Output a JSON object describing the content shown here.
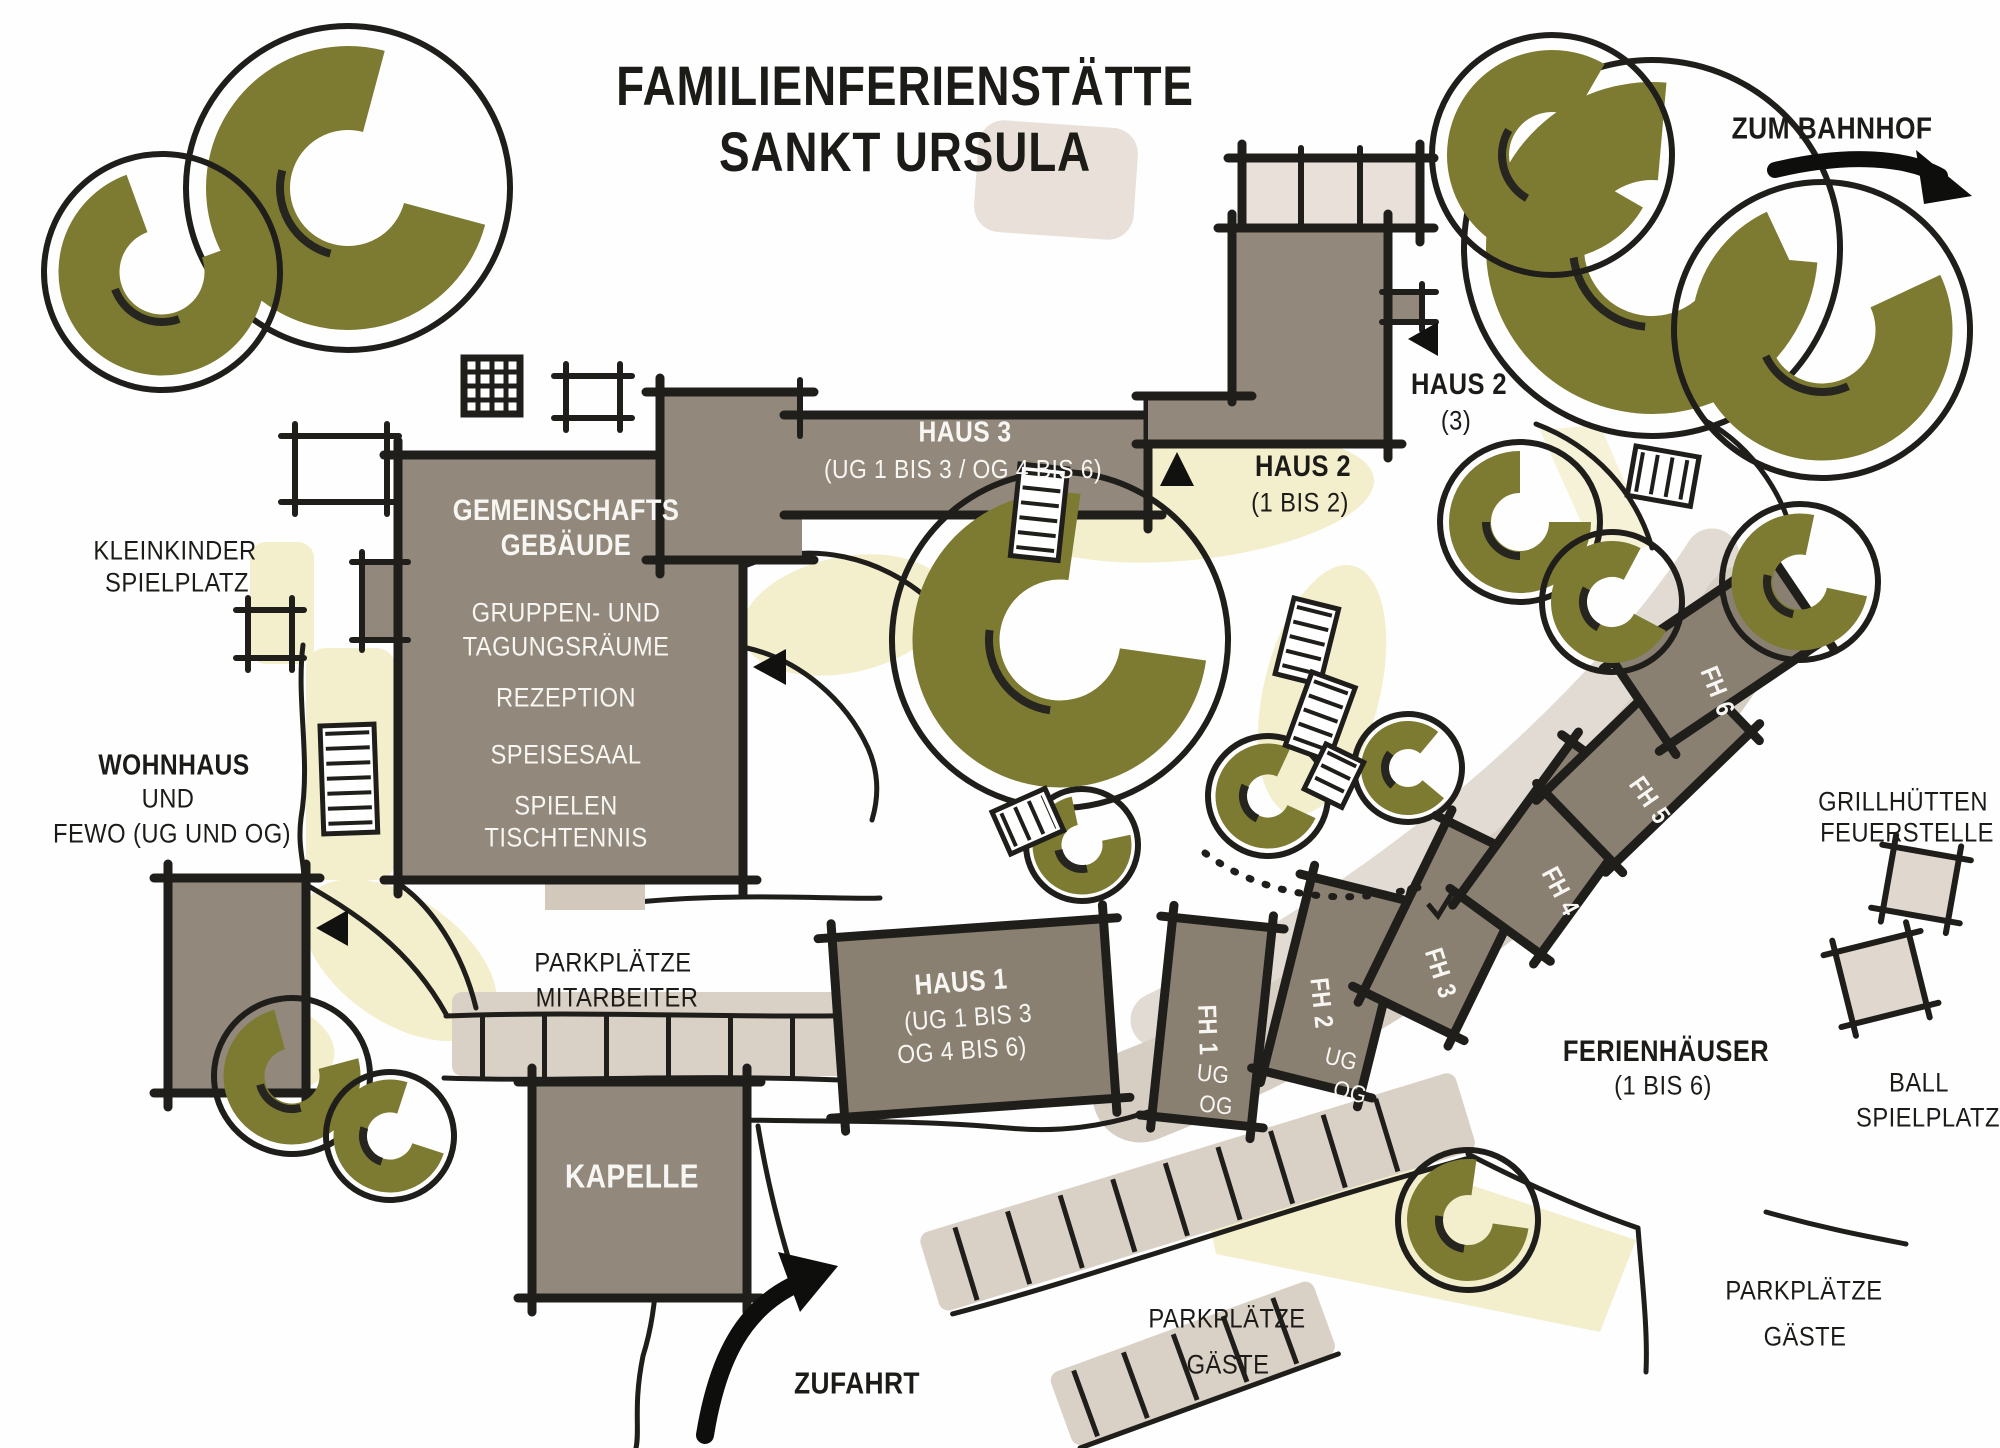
{
  "title": {
    "line1": "FAMILIENFERIENSTÄTTE",
    "line2": "SANKT URSULA"
  },
  "directions": {
    "to_station": "ZUM BAHNHOF",
    "driveway": "ZUFAHRT"
  },
  "buildings": {
    "gemeinschaftsgebaeude": {
      "name1": "GEMEINSCHAFTS",
      "name2": "GEBÄUDE",
      "rooms": [
        "GRUPPEN- UND",
        "TAGUNGSRÄUME",
        "REZEPTION",
        "SPEISESAAL",
        "SPIELEN",
        "TISCHTENNIS"
      ]
    },
    "haus1": {
      "name": "HAUS 1",
      "sub1": "(UG 1 BIS 3",
      "sub2": "OG 4 BIS 6)"
    },
    "haus2_upper": {
      "name": "HAUS 2",
      "sub": "(3)"
    },
    "haus2_lower": {
      "name": "HAUS 2",
      "sub": "(1 BIS 2)"
    },
    "haus3": {
      "name": "HAUS 3",
      "sub": "(UG 1 BIS 3 / OG 4 BIS 6)"
    },
    "kapelle": {
      "name": "KAPELLE"
    },
    "wohnhaus": {
      "name": "WOHNHAUS",
      "sub1": "UND",
      "sub2": "FEWO (UG UND OG)"
    },
    "ferienhaeuser": {
      "group_name": "FERIENHÄUSER",
      "group_sub": "(1 BIS 6)",
      "houses": [
        {
          "abbr": "FH",
          "num": "1"
        },
        {
          "abbr": "FH",
          "num": "2"
        },
        {
          "abbr": "FH",
          "num": "3"
        },
        {
          "abbr": "FH",
          "num": "4"
        },
        {
          "abbr": "FH",
          "num": "5"
        },
        {
          "abbr": "FH",
          "num": "6"
        }
      ],
      "floors": {
        "ug": "UG",
        "og": "OG"
      }
    }
  },
  "areas": {
    "kleinkinder_spielplatz": {
      "line1": "KLEINKINDER",
      "line2": "SPIELPLATZ"
    },
    "parkplaetze_mitarbeiter": {
      "line1": "PARKPLÄTZE",
      "line2": "MITARBEITER"
    },
    "parkplaetze_gaeste_mitte": {
      "line1": "PARKPLÄTZE",
      "line2": "GÄSTE"
    },
    "parkplaetze_gaeste_rechts": {
      "line1": "PARKPLÄTZE",
      "line2": "GÄSTE"
    },
    "grillhuetten": {
      "line1": "GRILLHÜTTEN",
      "line2": "FEUERSTELLE"
    },
    "ballspielplatz": {
      "line1": "BALL",
      "line2": "SPIELPLATZ"
    }
  },
  "colors": {
    "building": "#92897c",
    "building_dark": "#8a8072",
    "tree_olive": "#7d7b32",
    "path_yellow": "#f3efcd",
    "path_light": "#d2c8bc",
    "ink": "#1f1e1b"
  }
}
